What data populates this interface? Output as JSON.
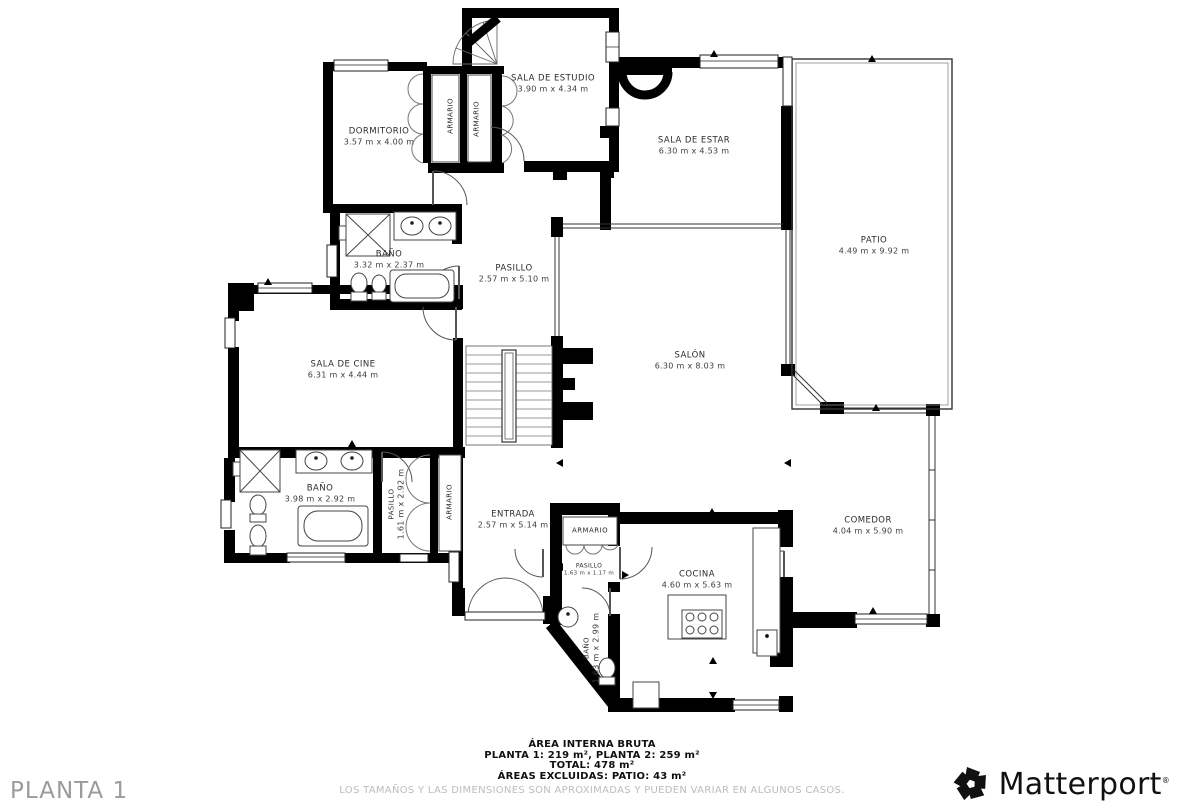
{
  "floor_label": "PLANTA 1",
  "rooms": [
    {
      "name": "SALA DE ESTUDIO",
      "dims": "3.90 m x 4.34 m"
    },
    {
      "name": "DORMITORIO",
      "dims": "3.57 m x 4.00 m"
    },
    {
      "name": "ARMARIO",
      "dims": ""
    },
    {
      "name": "ARMARIO",
      "dims": ""
    },
    {
      "name": "SALA DE ESTAR",
      "dims": "6.30 m x 4.53 m"
    },
    {
      "name": "PATIO",
      "dims": "4.49 m x 9.92 m"
    },
    {
      "name": "BAÑO",
      "dims": "3.32 m x 2.37 m"
    },
    {
      "name": "PASILLO",
      "dims": "2.57 m x 5.10 m"
    },
    {
      "name": "SALA DE CINE",
      "dims": "6.31 m x 4.44 m"
    },
    {
      "name": "SALÓN",
      "dims": "6.30 m x 8.03 m"
    },
    {
      "name": "BAÑO",
      "dims": "3.98 m x 2.92 m"
    },
    {
      "name": "PASILLO",
      "dims": "1.61 m x 2.92 m"
    },
    {
      "name": "ARMARIO",
      "dims": ""
    },
    {
      "name": "ENTRADA",
      "dims": "2.57 m x 5.14 m"
    },
    {
      "name": "ARMARIO",
      "dims": ""
    },
    {
      "name": "PASILLO",
      "dims": "1.63 m x 1.17 m"
    },
    {
      "name": "COCINA",
      "dims": "4.60 m x 5.63 m"
    },
    {
      "name": "BAÑO",
      "dims": "1.63 m x 2.99 m"
    },
    {
      "name": "COMEDOR",
      "dims": "4.04 m x 5.90 m"
    }
  ],
  "footer": {
    "title": "ÁREA INTERNA BRUTA",
    "line2": "PLANTA 1: 219 m², PLANTA 2: 259 m²",
    "line3": "TOTAL: 478 m²",
    "line4": "ÁREAS EXCLUIDAS: PATIO: 43 m²",
    "disclaimer": "LOS TAMAÑOS Y LAS DIMENSIONES SON APROXIMADAS Y PUEDEN VARIAR EN ALGUNOS CASOS."
  },
  "brand": {
    "name": "Matterport",
    "mark": "®"
  }
}
